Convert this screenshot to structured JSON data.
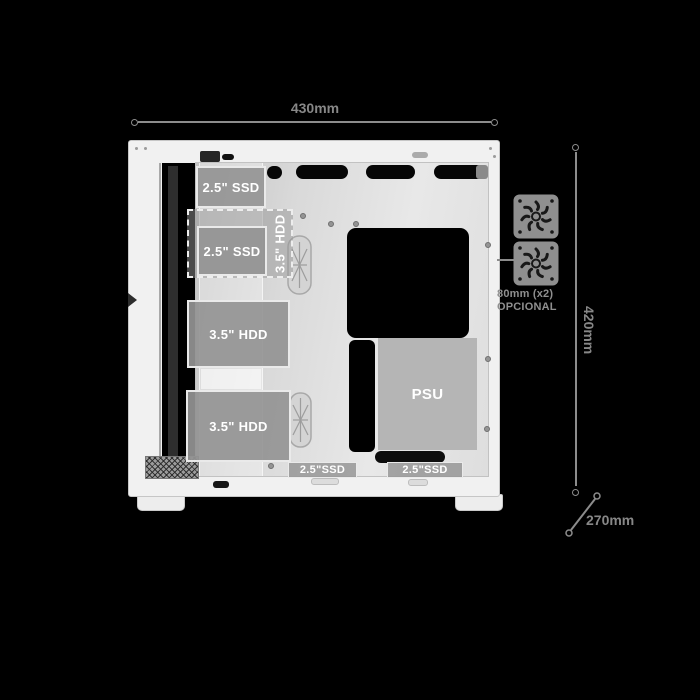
{
  "diagram": {
    "type": "pc-case-internal-layout-side-view",
    "background": "#000000"
  },
  "dimensions": {
    "width_label": "430mm",
    "height_label": "420mm",
    "depth_label": "270mm"
  },
  "fan_note": {
    "line1": "80mm (x2)",
    "line2": "OPCIONAL"
  },
  "bays": {
    "ssd_top": "2.5\" SSD",
    "hdd_optional": "3.5\" HDD",
    "ssd_mid": "2.5\" SSD",
    "hdd_upper": "3.5\" HDD",
    "hdd_lower": "3.5\" HDD",
    "psu": "PSU",
    "ssd_floor_left": "2.5\"SSD",
    "ssd_floor_right": "2.5\"SSD"
  },
  "icons": {
    "fan_top": "fan-icon",
    "fan_bottom": "fan-icon",
    "cable_grommet": "grommet-icon"
  },
  "colors": {
    "background": "#000000",
    "case_body": "#f1f1f1",
    "tray": "#dddddd",
    "bay_fill": "#949494",
    "bay_text": "#ffffff",
    "dimension_text": "#878787",
    "fan_icon": "#8f8f8f"
  }
}
